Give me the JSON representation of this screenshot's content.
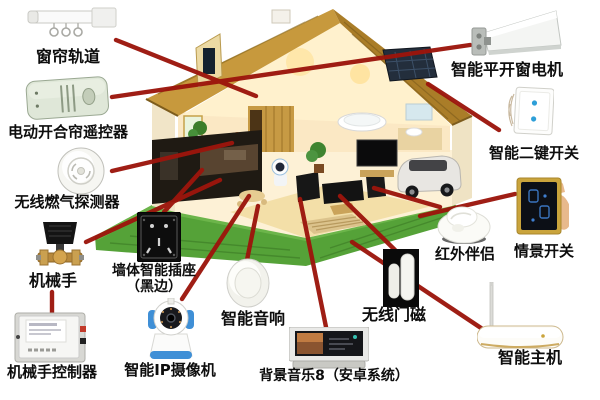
{
  "diagram": {
    "type": "smart-home-connection-diagram",
    "center_subject": "cutaway-house",
    "line_color": "#9c150c",
    "grass_color": "#55a238",
    "roof_color": "#c7993d"
  },
  "devices": [
    {
      "id": "curtain-track",
      "label": "窗帘轨道"
    },
    {
      "id": "curtain-remote",
      "label": "电动开合帘遥控器"
    },
    {
      "id": "gas-detector",
      "label": "无线燃气探测器"
    },
    {
      "id": "robot-hand",
      "label": "机械手"
    },
    {
      "id": "robot-hand-controller",
      "label": "机械手控制器"
    },
    {
      "id": "wall-socket",
      "label": "墙体智能插座",
      "label2": "（黑边）"
    },
    {
      "id": "ip-camera",
      "label": "智能IP摄像机"
    },
    {
      "id": "smart-speaker",
      "label": "智能音响"
    },
    {
      "id": "background-music",
      "label": "背景音乐8（安卓系统）"
    },
    {
      "id": "door-magnet",
      "label": "无线门磁"
    },
    {
      "id": "infrared-companion",
      "label": "红外伴侣"
    },
    {
      "id": "window-motor",
      "label": "智能平开窗电机"
    },
    {
      "id": "two-key-switch",
      "label": "智能二键开关"
    },
    {
      "id": "scene-switch",
      "label": "情景开关"
    },
    {
      "id": "smart-host",
      "label": "智能主机"
    }
  ]
}
